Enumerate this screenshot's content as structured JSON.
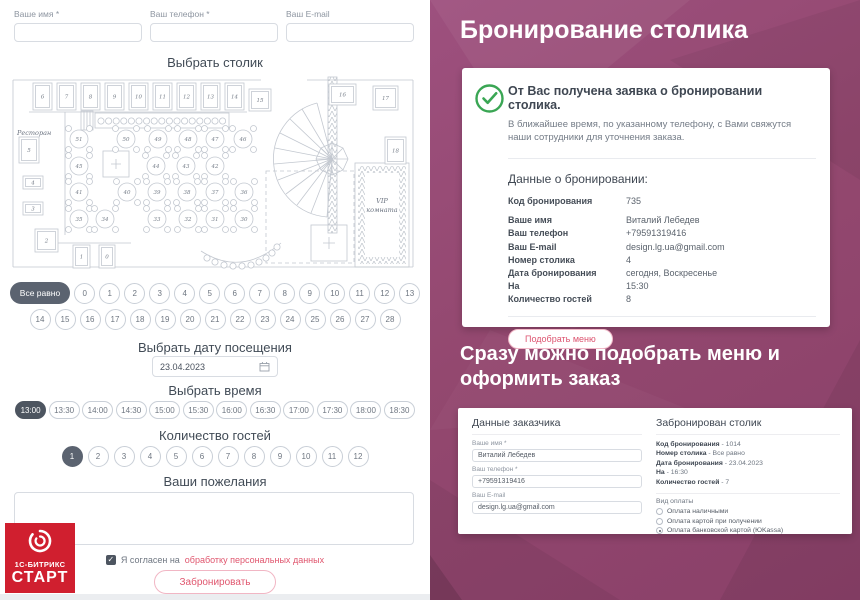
{
  "form": {
    "fields": [
      {
        "label": "Ваше имя *",
        "value": ""
      },
      {
        "label": "Ваш телефон *",
        "value": ""
      },
      {
        "label": "Ваш E-mail",
        "value": ""
      }
    ],
    "choose_table_title": "Выбрать столик",
    "floor_plan": {
      "restaurant_label": "Ресторан",
      "vip_line1": "VIP",
      "vip_line2": "комната",
      "booths": [
        {
          "n": "6",
          "x": 22,
          "y": 8,
          "w": 19,
          "h": 27
        },
        {
          "n": "7",
          "x": 46,
          "y": 8,
          "w": 19,
          "h": 27
        },
        {
          "n": "8",
          "x": 70,
          "y": 8,
          "w": 19,
          "h": 27
        },
        {
          "n": "9",
          "x": 94,
          "y": 8,
          "w": 19,
          "h": 27
        },
        {
          "n": "10",
          "x": 118,
          "y": 8,
          "w": 19,
          "h": 27
        },
        {
          "n": "11",
          "x": 142,
          "y": 8,
          "w": 19,
          "h": 27
        },
        {
          "n": "12",
          "x": 166,
          "y": 8,
          "w": 19,
          "h": 27
        },
        {
          "n": "13",
          "x": 190,
          "y": 8,
          "w": 19,
          "h": 27
        },
        {
          "n": "14",
          "x": 214,
          "y": 8,
          "w": 19,
          "h": 27
        },
        {
          "n": "15",
          "x": 238,
          "y": 14,
          "w": 22,
          "h": 22
        },
        {
          "n": "16",
          "x": 318,
          "y": 9,
          "w": 27,
          "h": 21
        },
        {
          "n": "17",
          "x": 362,
          "y": 11,
          "w": 25,
          "h": 24
        },
        {
          "n": "18",
          "x": 374,
          "y": 62,
          "w": 21,
          "h": 27
        },
        {
          "n": "5",
          "x": 8,
          "y": 62,
          "w": 20,
          "h": 26
        },
        {
          "n": "4",
          "x": 12,
          "y": 101,
          "w": 20,
          "h": 13
        },
        {
          "n": "3",
          "x": 12,
          "y": 127,
          "w": 20,
          "h": 13
        },
        {
          "n": "2",
          "x": 24,
          "y": 154,
          "w": 23,
          "h": 23
        },
        {
          "n": "1",
          "x": 62,
          "y": 170,
          "w": 17,
          "h": 23
        },
        {
          "n": "0",
          "x": 88,
          "y": 170,
          "w": 16,
          "h": 23
        }
      ],
      "round_tables": [
        {
          "n": "51",
          "x": 68,
          "y": 64
        },
        {
          "n": "50",
          "x": 115,
          "y": 64
        },
        {
          "n": "49",
          "x": 147,
          "y": 64
        },
        {
          "n": "48",
          "x": 177,
          "y": 64
        },
        {
          "n": "47",
          "x": 204,
          "y": 64
        },
        {
          "n": "46",
          "x": 232,
          "y": 64
        },
        {
          "n": "45",
          "x": 68,
          "y": 91
        },
        {
          "n": "44",
          "x": 145,
          "y": 91
        },
        {
          "n": "43",
          "x": 175,
          "y": 91
        },
        {
          "n": "42",
          "x": 204,
          "y": 91
        },
        {
          "n": "41",
          "x": 68,
          "y": 117
        },
        {
          "n": "40",
          "x": 116,
          "y": 117
        },
        {
          "n": "39",
          "x": 146,
          "y": 117
        },
        {
          "n": "38",
          "x": 176,
          "y": 117
        },
        {
          "n": "37",
          "x": 204,
          "y": 117
        },
        {
          "n": "36",
          "x": 233,
          "y": 117
        },
        {
          "n": "35",
          "x": 68,
          "y": 144
        },
        {
          "n": "34",
          "x": 94,
          "y": 144
        },
        {
          "n": "33",
          "x": 146,
          "y": 144
        },
        {
          "n": "32",
          "x": 177,
          "y": 144
        },
        {
          "n": "31",
          "x": 204,
          "y": 144
        },
        {
          "n": "30",
          "x": 233,
          "y": 144
        }
      ]
    },
    "table_any_label": "Все равно",
    "table_numbers_row1": [
      "0",
      "1",
      "2",
      "3",
      "4",
      "5",
      "6",
      "7",
      "8",
      "9",
      "10",
      "11",
      "12",
      "13"
    ],
    "table_numbers_row2": [
      "14",
      "15",
      "16",
      "17",
      "18",
      "19",
      "20",
      "21",
      "22",
      "23",
      "24",
      "25",
      "26",
      "27",
      "28"
    ],
    "choose_date_title": "Выбрать дату посещения",
    "date_value": "23.04.2023",
    "choose_time_title": "Выбрать время",
    "times": [
      "13:00",
      "13:30",
      "14:00",
      "14:30",
      "15:00",
      "15:30",
      "16:00",
      "16:30",
      "17:00",
      "17:30",
      "18:00",
      "18:30"
    ],
    "selected_time": "13:00",
    "guests_title": "Количество гостей",
    "guest_numbers": [
      "1",
      "2",
      "3",
      "4",
      "5",
      "6",
      "7",
      "8",
      "9",
      "10",
      "11",
      "12"
    ],
    "selected_guest": "1",
    "wishes_title": "Ваши пожелания",
    "consent_text": "Я согласен на",
    "consent_link": "обработку персональных данных",
    "submit_label": "Забронировать",
    "logo": {
      "line1": "1С-БИТРИКС",
      "line2": "СТАРТ"
    }
  },
  "right": {
    "title": "Бронирование столика",
    "card1": {
      "headline": "От Вас получена заявка о бронировании столика.",
      "subtext": "В ближайшее время, по указанному телефону, с Вами свяжутся наши сотрудники для уточнения заказа.",
      "data_title": "Данные о бронировании:",
      "rows": [
        {
          "label": "Код бронирования",
          "value": "735"
        },
        {
          "label": "Ваше имя",
          "value": "Виталий Лебедев"
        },
        {
          "label": "Ваш телефон",
          "value": "+79591319416"
        },
        {
          "label": "Ваш E-mail",
          "value": "design.lg.ua@gmail.com"
        },
        {
          "label": "Номер столика",
          "value": "4"
        },
        {
          "label": "Дата бронирования",
          "value": "сегодня, Воскресенье"
        },
        {
          "label": "На",
          "value": "15:30"
        },
        {
          "label": "Количество гостей",
          "value": "8"
        }
      ],
      "button_label": "Подобрать меню"
    },
    "subtitle": "Сразу можно подобрать меню и оформить заказ",
    "card2": {
      "customer_title": "Данные заказчика",
      "fields": [
        {
          "label": "Ваше имя *",
          "value": "Виталий Лебедев"
        },
        {
          "label": "Ваш телефон *",
          "value": "+79591319416"
        },
        {
          "label": "Ваш E-mail",
          "value": "design.lg.ua@gmail.com"
        }
      ],
      "booked_title": "Забронирован столик",
      "rows": [
        {
          "label": "Код бронирования",
          "value": "1014"
        },
        {
          "label": "Номер столика",
          "value": "Все равно"
        },
        {
          "label": "Дата бронирования",
          "value": "23.04.2023"
        },
        {
          "label": "На",
          "value": "16:30"
        },
        {
          "label": "Количество гостей",
          "value": "7"
        }
      ],
      "payment_title": "Вид оплаты",
      "payment_options": [
        {
          "label": "Оплата наличными",
          "checked": false
        },
        {
          "label": "Оплата картой при получении",
          "checked": false
        },
        {
          "label": "Оплата банковской картой (ЮKassa)",
          "checked": true
        }
      ]
    }
  },
  "colors": {
    "accent_pink": "#e0566e",
    "purple_bg": "#93486f",
    "selected_dark": "#5b6370",
    "success_green": "#3aa654",
    "logo_red": "#d01f2f"
  }
}
